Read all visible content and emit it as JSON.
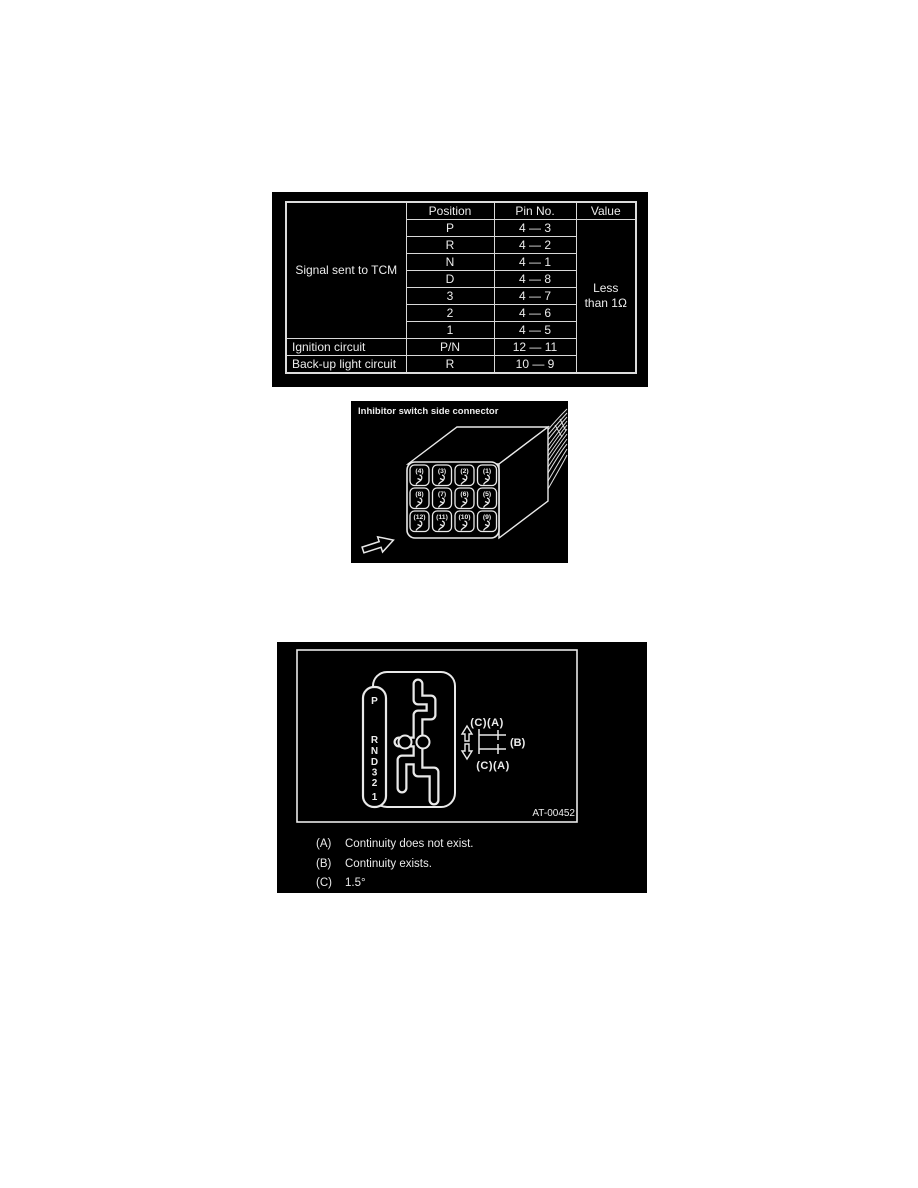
{
  "page": {
    "background": "#ffffff",
    "paper": "#000000",
    "ink": "#ececec"
  },
  "resistance_table": {
    "headers": {
      "position": "Position",
      "pin_no": "Pin No.",
      "value": "Value"
    },
    "rows": [
      {
        "group": "Signal sent to TCM",
        "position": "P",
        "pin_no": "4 — 3"
      },
      {
        "position": "R",
        "pin_no": "4 — 2"
      },
      {
        "position": "N",
        "pin_no": "4 — 1"
      },
      {
        "position": "D",
        "pin_no": "4 — 8"
      },
      {
        "position": "3",
        "pin_no": "4 — 7"
      },
      {
        "position": "2",
        "pin_no": "4 — 6"
      },
      {
        "position": "1",
        "pin_no": "4 — 5"
      },
      {
        "group": "Ignition circuit",
        "position": "P/N",
        "pin_no": "12 — 11"
      },
      {
        "group": "Back-up light circuit",
        "position": "R",
        "pin_no": "10 — 9"
      }
    ],
    "value": "Less than 1Ω"
  },
  "connector": {
    "title": "Inhibitor switch side connector",
    "pins": [
      "(4)",
      "(3)",
      "(2)",
      "(1)",
      "(8)",
      "(7)",
      "(6)",
      "(5)",
      "(12)",
      "(11)",
      "(10)",
      "(9)"
    ]
  },
  "shift_gate": {
    "positions": [
      "P",
      "R",
      "N",
      "D",
      "3",
      "2",
      "1"
    ],
    "annotation_top": "(C)(A)",
    "annotation_middle": "(B)",
    "annotation_bottom": "(C)(A)",
    "figure_id": "AT-00452"
  },
  "legend": {
    "items": [
      {
        "key": "(A)",
        "text": "Continuity does not exist."
      },
      {
        "key": "(B)",
        "text": "Continuity exists."
      },
      {
        "key": "(C)",
        "text": "1.5°"
      }
    ]
  }
}
